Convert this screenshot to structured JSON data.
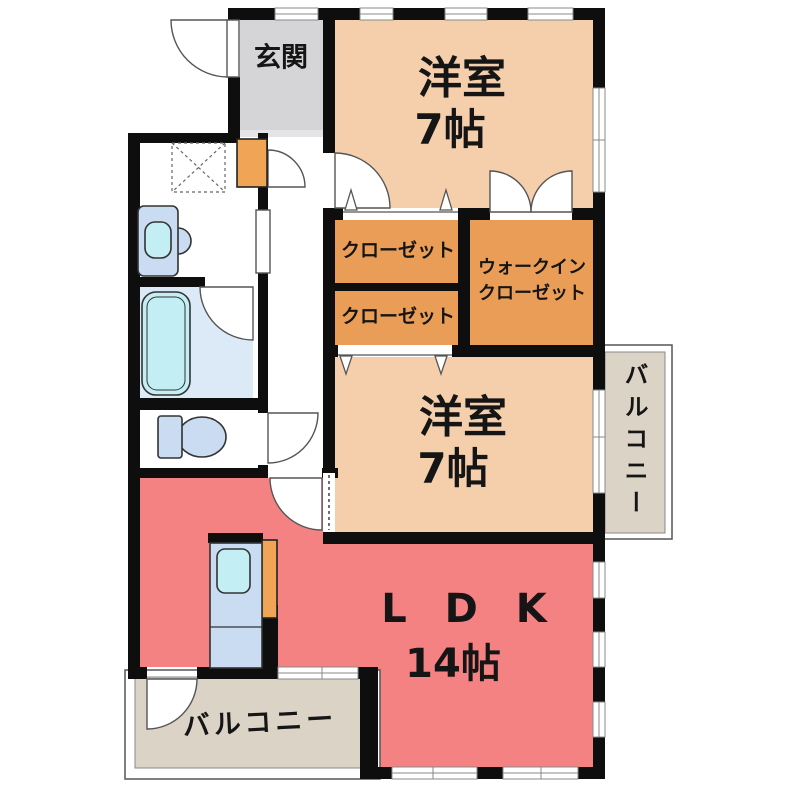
{
  "rooms": {
    "genkan": {
      "label": "玄関"
    },
    "bedroom_top": {
      "name": "洋室",
      "size": "7帖"
    },
    "closet_upper": {
      "label": "クローゼット"
    },
    "closet_lower": {
      "label": "クローゼット"
    },
    "walk_in_closet": {
      "line1": "ウォークイン",
      "line2": "クローゼット"
    },
    "bedroom_middle": {
      "name": "洋室",
      "size": "7帖"
    },
    "balcony_right": {
      "label": "バルコニー"
    },
    "ldk": {
      "name": "L D K",
      "size": "14帖"
    },
    "balcony_bottom": {
      "label": "バルコニー"
    }
  },
  "colors": {
    "wall": "#0e0e0e",
    "bedroom_fill": "#F5CFAB",
    "closet_fill": "#E99D57",
    "accent_orange": "#F0A455",
    "ldk_fill": "#F58282",
    "genkan_fill": "#D5D5D7",
    "genkan_step": "#E4E4E6",
    "balcony_fill": "#DBD3C6",
    "bath_fill": "#DCEAF7",
    "fixture_blue": "#C9DCF2",
    "fixture_cyan": "#C2EEF4",
    "line": "#555555",
    "text": "#151515",
    "bg": "#FFFFFF"
  }
}
